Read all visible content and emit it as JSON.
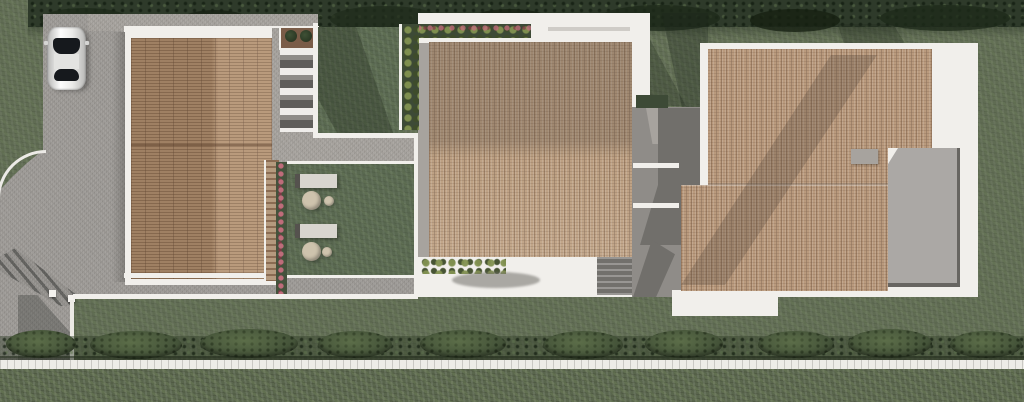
{
  "scene": {
    "kind": "architectural-site-plan",
    "view": "top-down-render",
    "objects": {
      "car": "white car parked on driveway",
      "driveway": "grey paved driveway with curved curb and gate shadow",
      "left_house": "house with terracotta tiled roof",
      "middle_house": "house with terracotta tiled roof and white apron",
      "right_house": "house with tiled roof and flat grey roof terrace",
      "inner_courtyard": "shaded courtyard between middle and right house",
      "lawn": "lawn with two sun loungers and round tables",
      "pergola": "wooden pergola strip",
      "flower_border": "pink flower border",
      "planter": "planter box with two shrubs",
      "stairs": "outdoor stair strip",
      "garden_bed": "bed of yellow-green shrubs",
      "shrub_row": "row of low shrubs with shadow",
      "hedge_top": "boundary hedge along top",
      "hedge_bottom": "roadside hedge row",
      "garden_path": "white path along bottom",
      "terrace": "flat roof terrace",
      "chimney": "roof chimney block"
    }
  },
  "palette": {
    "base_grass": "#606c53",
    "lawn": "#596850",
    "hedge_dark": "#2e3a2a",
    "bush": "#46553a",
    "pavement": "#9e9b97",
    "pavement_light": "#a7a39e",
    "white_surface": "#f1efeb",
    "roof_left": "#b2906f",
    "roof_mid": "#bfa284",
    "roof_right": "#b99a7d",
    "terrace_gray": "#aba8a5",
    "courtyard_gray": "#8f8c88",
    "courtyard_dark": "#716f6b",
    "stair_gray": "#827f7b",
    "garden_bed": "#3d4a36",
    "flower_base": "#44523c",
    "shrub_green": "#5e6e3f",
    "path_white": "#edece7",
    "wood": "#b59a7e",
    "car_body": "#e9e9e7",
    "car_glass": "#16191d",
    "furniture": "#d8d5cf",
    "table_tan": "#cec3ad"
  }
}
